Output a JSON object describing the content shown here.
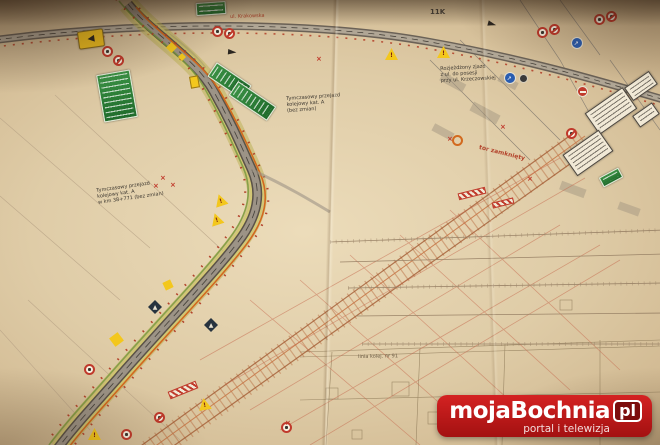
{
  "watermark": {
    "brand": "mojaBochnia",
    "tld": "pl",
    "tagline": "portal i telewizja",
    "logo_red": "#c41818"
  },
  "colors": {
    "paper": "#dfcca7",
    "road_olive": "#b9b050",
    "road_gray": "#9c9386",
    "railway_orange": "#b5653a",
    "sign_green": "#2e7d32",
    "sign_yellow": "#f3c71d",
    "sign_red": "#c0392b",
    "sign_blue": "#2a5db0"
  },
  "annotations": [
    {
      "x": 96,
      "y": 188,
      "rot": -8,
      "size": 5,
      "color": "#3a352e",
      "bold": false,
      "lines": [
        "Tymczasowy przejazd",
        "kolejowy kat. A",
        "w km 38+771 (bez zmian)"
      ]
    },
    {
      "x": 286,
      "y": 96,
      "rot": -4,
      "size": 5,
      "color": "#3a352e",
      "bold": false,
      "lines": [
        "Tymczasowy przejazd",
        "kolejowy kat. A",
        "(bez zmian)"
      ]
    },
    {
      "x": 440,
      "y": 66,
      "rot": -3,
      "size": 5,
      "color": "#3a352e",
      "bold": false,
      "lines": [
        "Rozjeżdżony zjazd",
        "z ul. do posesji",
        "przy ul. Krzeczowskiej"
      ]
    },
    {
      "x": 480,
      "y": 144,
      "rot": 14,
      "size": 6,
      "color": "#b3432b",
      "bold": true,
      "lines": [
        "tor zamknięty"
      ]
    },
    {
      "x": 358,
      "y": 354,
      "rot": -1,
      "size": 5,
      "color": "#6b5b44",
      "bold": false,
      "lines": [
        "linia kolej. nr 91"
      ]
    },
    {
      "x": 430,
      "y": 8,
      "rot": 0,
      "size": 7,
      "color": "#4a443c",
      "bold": true,
      "lines": [
        "11K"
      ]
    },
    {
      "x": 230,
      "y": 14,
      "rot": -2,
      "size": 5,
      "color": "#b3432b",
      "bold": false,
      "lines": [
        "ul. Krakowska"
      ]
    }
  ],
  "signs": [
    {
      "type": "green-board",
      "x": 100,
      "y": 72,
      "w": 34,
      "h": 48,
      "rot": -10
    },
    {
      "type": "green-board",
      "x": 221,
      "y": 60,
      "w": 17,
      "h": 42,
      "rot": -56
    },
    {
      "type": "green-board",
      "x": 244,
      "y": 78,
      "w": 17,
      "h": 46,
      "rot": -56
    },
    {
      "type": "green-board",
      "x": 196,
      "y": 2,
      "w": 30,
      "h": 13,
      "rot": -4
    },
    {
      "type": "green-board",
      "x": 600,
      "y": 172,
      "w": 22,
      "h": 11,
      "rot": -28
    },
    {
      "type": "yellow-trumpet",
      "x": 78,
      "y": 30,
      "w": 26,
      "h": 18,
      "rot": -8
    },
    {
      "type": "yellow-triangle",
      "x": 385,
      "y": 48,
      "rot": 0
    },
    {
      "type": "yellow-triangle",
      "x": 437,
      "y": 46,
      "rot": 0
    },
    {
      "type": "yellow-triangle",
      "x": 214,
      "y": 194,
      "rot": -18
    },
    {
      "type": "yellow-triangle",
      "x": 210,
      "y": 213,
      "rot": -18
    },
    {
      "type": "yellow-triangle",
      "x": 88,
      "y": 428,
      "rot": 0
    },
    {
      "type": "yellow-triangle",
      "x": 198,
      "y": 398,
      "rot": -10
    },
    {
      "type": "yellow-diamond",
      "x": 166,
      "y": 42,
      "w": 11,
      "h": 11,
      "rot": 0
    },
    {
      "type": "yellow-diamond",
      "x": 178,
      "y": 53,
      "w": 8,
      "h": 8,
      "rot": 0
    },
    {
      "type": "yellow-diamond",
      "x": 109,
      "y": 332,
      "w": 15,
      "h": 15,
      "rot": 8
    },
    {
      "type": "yellow-diamond",
      "x": 162,
      "y": 279,
      "w": 12,
      "h": 12,
      "rot": 20
    },
    {
      "type": "yellow-rect",
      "x": 190,
      "y": 76,
      "w": 9,
      "h": 12,
      "rot": -10
    },
    {
      "type": "red-circle",
      "x": 102,
      "y": 46,
      "rot": -8
    },
    {
      "type": "red-circle",
      "x": 113,
      "y": 55,
      "rot": -8,
      "variant": "slash"
    },
    {
      "type": "red-circle",
      "x": 212,
      "y": 26,
      "rot": 0
    },
    {
      "type": "red-circle",
      "x": 224,
      "y": 28,
      "rot": 0,
      "variant": "slash"
    },
    {
      "type": "red-circle",
      "x": 537,
      "y": 27,
      "rot": 6
    },
    {
      "type": "red-circle",
      "x": 549,
      "y": 24,
      "rot": 6,
      "variant": "slash"
    },
    {
      "type": "red-circle",
      "x": 594,
      "y": 14,
      "rot": 6
    },
    {
      "type": "red-circle",
      "x": 606,
      "y": 11,
      "rot": 6,
      "variant": "slash"
    },
    {
      "type": "red-circle",
      "x": 566,
      "y": 128,
      "rot": 0,
      "variant": "slash"
    },
    {
      "type": "red-circle",
      "x": 84,
      "y": 364,
      "rot": 0
    },
    {
      "type": "red-circle",
      "x": 121,
      "y": 429,
      "rot": 0
    },
    {
      "type": "red-circle",
      "x": 154,
      "y": 412,
      "rot": 0,
      "variant": "slash"
    },
    {
      "type": "red-circle",
      "x": 281,
      "y": 422,
      "rot": 0
    },
    {
      "type": "no-entry-circle",
      "x": 577,
      "y": 86,
      "rot": 0
    },
    {
      "type": "orange-circle",
      "x": 452,
      "y": 135,
      "rot": 0
    },
    {
      "type": "blue-circle",
      "x": 571,
      "y": 37,
      "rot": 0
    },
    {
      "type": "blue-circle",
      "x": 504,
      "y": 72,
      "rot": 0
    },
    {
      "type": "dark-circle",
      "x": 519,
      "y": 74,
      "rot": 0
    },
    {
      "type": "dark-diamond",
      "x": 148,
      "y": 300,
      "rot": 0
    },
    {
      "type": "dark-diamond",
      "x": 204,
      "y": 318,
      "rot": 0
    },
    {
      "type": "white-board",
      "x": 588,
      "y": 98,
      "w": 46,
      "h": 26,
      "rot": -35
    },
    {
      "type": "white-board",
      "x": 566,
      "y": 140,
      "w": 44,
      "h": 26,
      "rot": -35
    },
    {
      "type": "white-board",
      "x": 626,
      "y": 78,
      "w": 30,
      "h": 16,
      "rot": -35
    },
    {
      "type": "white-board",
      "x": 634,
      "y": 108,
      "w": 24,
      "h": 14,
      "rot": -35
    },
    {
      "type": "red-hatch-bar",
      "x": 168,
      "y": 386,
      "w": 30,
      "h": 8,
      "rot": -22
    },
    {
      "type": "red-hatch-bar",
      "x": 458,
      "y": 190,
      "w": 28,
      "h": 7,
      "rot": -14
    },
    {
      "type": "red-hatch-bar",
      "x": 492,
      "y": 200,
      "w": 22,
      "h": 6,
      "rot": -14
    },
    {
      "type": "dark-arrow",
      "x": 228,
      "y": 46,
      "rot": 5
    },
    {
      "type": "dark-arrow",
      "x": 488,
      "y": 18,
      "rot": 15
    },
    {
      "type": "red-x",
      "x": 160,
      "y": 175,
      "rot": 0
    },
    {
      "type": "red-x",
      "x": 170,
      "y": 182,
      "rot": 0
    },
    {
      "type": "red-x",
      "x": 153,
      "y": 183,
      "rot": 0
    },
    {
      "type": "red-x",
      "x": 447,
      "y": 136,
      "rot": 0
    },
    {
      "type": "red-x",
      "x": 500,
      "y": 124,
      "rot": 0
    },
    {
      "type": "red-x",
      "x": 285,
      "y": 420,
      "rot": 0
    },
    {
      "type": "red-x",
      "x": 527,
      "y": 176,
      "rot": 0
    },
    {
      "type": "red-x",
      "x": 316,
      "y": 56,
      "rot": 0
    }
  ]
}
